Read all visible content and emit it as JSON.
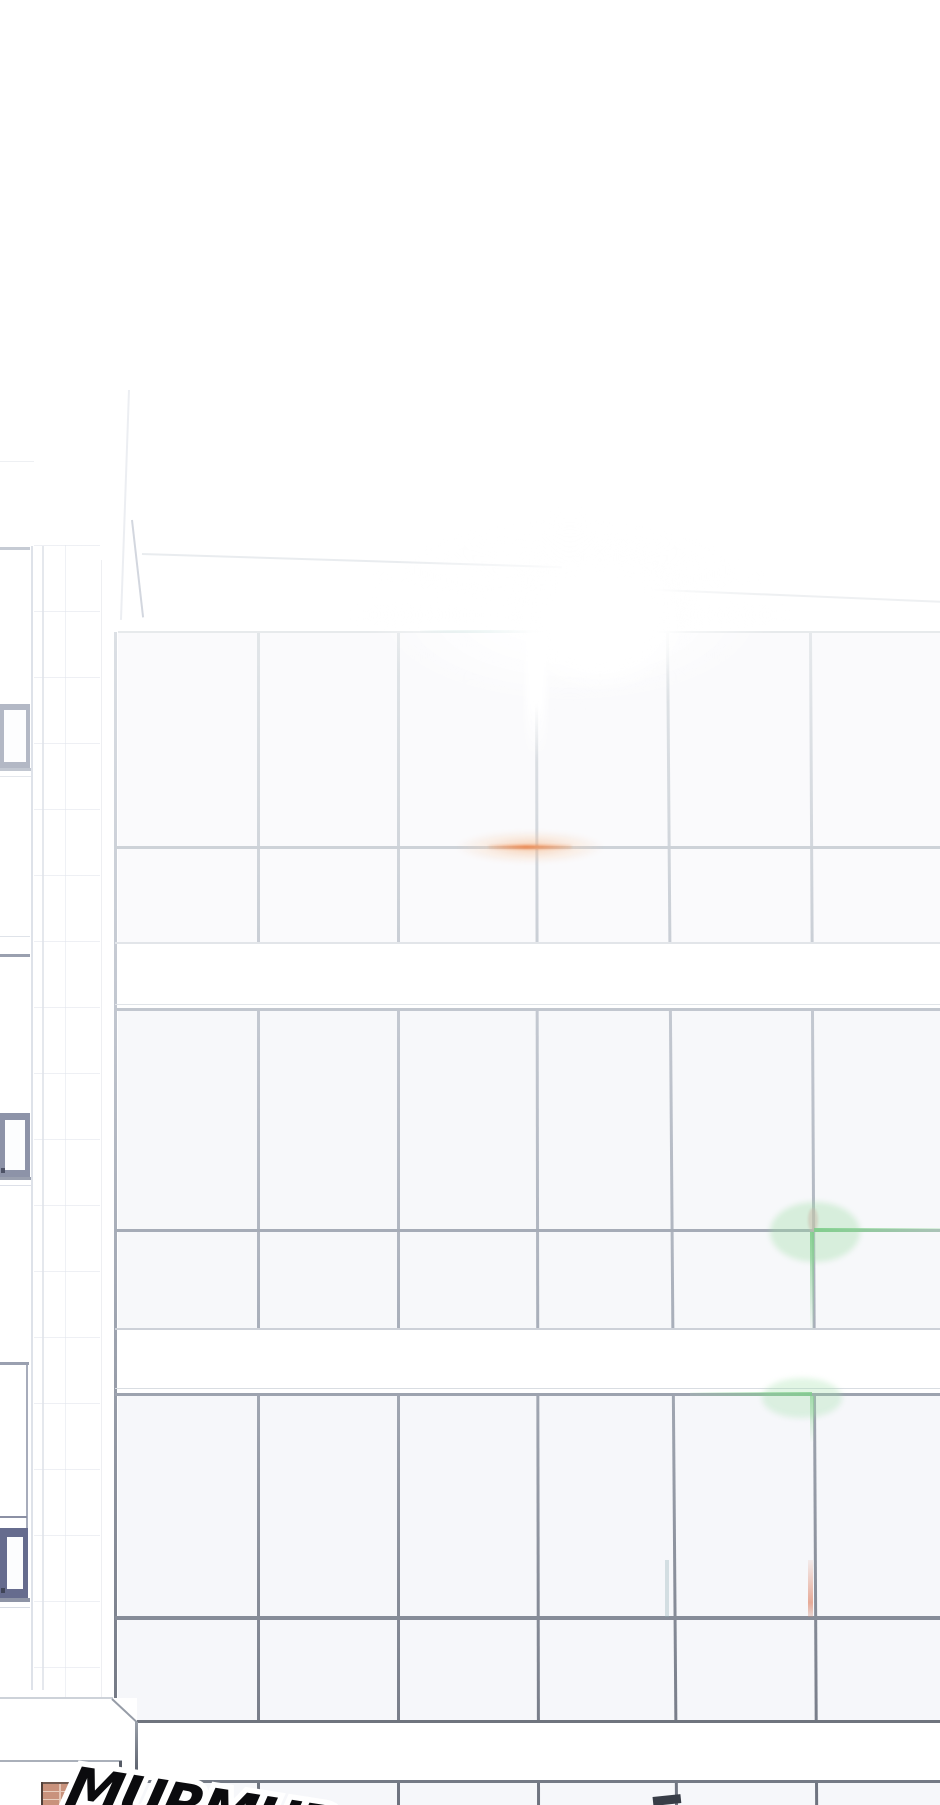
{
  "panel": {
    "type": "webtoon-panel",
    "scene": "low-angle view of a sunlit office building glass curtain wall, white overexposed sky, tiled side building on the left, street level with brick pillar at bottom"
  },
  "sfx": {
    "text": "MURMUR",
    "style": "bold italic black with white outline, partially cut off at bottom edge"
  },
  "palette": {
    "background": "#ffffff",
    "mullion_top": "#e2e6e9",
    "mullion_bottom": "#6e737f",
    "flare_orange": "#ee8246",
    "flare_green": "#80ce8c",
    "flare_cyan": "#8cc4be",
    "flare_salmon": "#e08a6e",
    "brick": "#c9927c",
    "sash_frame_dark": "#7a8099"
  },
  "layers": [
    {
      "name": "glass-tints",
      "items": [
        {
          "n": "glass-floor1-tint",
          "l": 118,
          "t": 633,
          "w": 822,
          "h": 309,
          "bg": "rgba(243,245,248,0.45)"
        },
        {
          "n": "glass-floor2-tint",
          "l": 118,
          "t": 1011,
          "w": 822,
          "h": 317,
          "bg": "rgba(240,242,246,0.5)"
        },
        {
          "n": "glass-floor3-tint",
          "l": 118,
          "t": 1396,
          "w": 822,
          "h": 324,
          "bg": "rgba(238,240,245,0.55)"
        },
        {
          "n": "glass-bottom-tint",
          "l": 137,
          "t": 1783,
          "w": 803,
          "h": 22,
          "bg": "rgba(238,240,245,0.5)"
        }
      ]
    },
    {
      "name": "side-building",
      "items": [
        {
          "n": "tile-wall-texture",
          "l": 34,
          "t": 545,
          "w": 66,
          "h": 1213,
          "bg": "repeating-linear-gradient(180deg, rgba(226,229,236,0.6) 0px 1px, rgba(0,0,0,0) 1px 66px)"
        },
        {
          "n": "tile-joint-vertical",
          "l": 65,
          "t": 545,
          "w": 1,
          "h": 1213,
          "bg": "rgba(226,229,236,0.55)"
        },
        {
          "n": "bay-corner-line-inner",
          "l": 31,
          "t": 546,
          "w": 2,
          "h": 1144,
          "bg": "rgba(214,219,227,0.8)"
        },
        {
          "n": "bay-corner-line-outer",
          "l": 42,
          "t": 546,
          "w": 2,
          "h": 1144,
          "bg": "rgba(222,226,233,0.8)"
        },
        {
          "n": "facade-column-edge-line",
          "l": 101,
          "t": 560,
          "w": 1,
          "h": 1138,
          "bg": "rgba(226,229,234,0.6)"
        },
        {
          "n": "tower-edge-upper",
          "l": 128,
          "t": 390,
          "w": 2,
          "h": 230,
          "bg": "rgba(228,231,237,0.7)",
          "r": 2,
          "o": "50% 0"
        },
        {
          "n": "tower-edge-lower",
          "l": 131,
          "t": 520,
          "w": 2,
          "h": 98,
          "bg": "rgba(203,208,217,0.85)",
          "r": -6.5,
          "o": "50% 0"
        },
        {
          "n": "roofline-near",
          "l": 142,
          "t": 553,
          "w": 420,
          "h": 2,
          "bg": "rgba(231,234,237,0.9)",
          "r": 1.8,
          "o": "left center"
        },
        {
          "n": "roofline-far",
          "l": 540,
          "t": 584,
          "w": 402,
          "h": 2,
          "bg": "rgba(236,238,241,0.9)",
          "r": 2.4,
          "o": "left center"
        },
        {
          "n": "parapet-faint-line",
          "l": 0,
          "t": 461,
          "w": 34,
          "h": 1,
          "bg": "rgba(236,238,242,0.9)"
        },
        {
          "n": "window-bay1-lintel",
          "l": 0,
          "t": 547,
          "w": 30,
          "h": 3,
          "bg": "#c6cbd4"
        },
        {
          "n": "window-bay1-sash-frame",
          "l": 0,
          "t": 704,
          "w": 30,
          "h": 64,
          "bg": "#b3b8c5"
        },
        {
          "n": "window-bay1-sash-pane",
          "l": 4,
          "t": 710,
          "w": 22,
          "h": 52,
          "bg": "#fdfdfe"
        },
        {
          "n": "window-bay1-sill",
          "l": 0,
          "t": 768,
          "w": 31,
          "h": 3,
          "bg": "#c2c7d1"
        },
        {
          "n": "window-bay1-sill-shadow",
          "l": 0,
          "t": 776,
          "w": 31,
          "h": 1,
          "bg": "#e4e7ec"
        },
        {
          "n": "window-bay2-lintel-hi",
          "l": 0,
          "t": 936,
          "w": 30,
          "h": 1,
          "bg": "#dfe3e9"
        },
        {
          "n": "window-bay2-lintel",
          "l": 0,
          "t": 954,
          "w": 30,
          "h": 3,
          "bg": "#9aa0af"
        },
        {
          "n": "window-bay2-sash-frame",
          "l": 0,
          "t": 1113,
          "w": 30,
          "h": 64,
          "bg": "#8d93a8"
        },
        {
          "n": "window-bay2-sash-pane",
          "l": 5,
          "t": 1120,
          "w": 20,
          "h": 50,
          "bg": "#fcfdfe"
        },
        {
          "n": "window-bay2-latch",
          "l": 1,
          "t": 1168,
          "w": 4,
          "h": 5,
          "bg": "#4d5266"
        },
        {
          "n": "window-bay2-sill",
          "l": 0,
          "t": 1177,
          "w": 31,
          "h": 3,
          "bg": "#9aa0af"
        },
        {
          "n": "window-bay2-sill-shadow",
          "l": 0,
          "t": 1185,
          "w": 31,
          "h": 1,
          "bg": "#dde0e8"
        },
        {
          "n": "window-bay3-lintel",
          "l": 0,
          "t": 1362,
          "w": 29,
          "h": 3,
          "bg": "#9aa0b0"
        },
        {
          "n": "window-bay3-side-line",
          "l": 26,
          "t": 1365,
          "w": 2,
          "h": 165,
          "bg": "#a7acbb"
        },
        {
          "n": "window-bay3-divider",
          "l": 0,
          "t": 1516,
          "w": 27,
          "h": 2,
          "bg": "#8b90a4"
        },
        {
          "n": "window-bay3-sash-frame",
          "l": 0,
          "t": 1528,
          "w": 28,
          "h": 70,
          "bg": "#666c8e"
        },
        {
          "n": "window-bay3-sash-pane",
          "l": 7,
          "t": 1537,
          "w": 16,
          "h": 52,
          "bg": "#fcfdfe"
        },
        {
          "n": "window-bay3-latch",
          "l": 1,
          "t": 1588,
          "w": 4,
          "h": 5,
          "bg": "#3f4457"
        },
        {
          "n": "window-bay3-sill",
          "l": 0,
          "t": 1598,
          "w": 30,
          "h": 4,
          "bg": "#8e94a6"
        },
        {
          "n": "window-bay3-sill-shadow",
          "l": 0,
          "t": 1607,
          "w": 30,
          "h": 1,
          "bg": "#d8dce4"
        }
      ]
    },
    {
      "name": "mullions",
      "items": [
        {
          "n": "mullion-col2",
          "l": 257,
          "t": 632,
          "w": 3,
          "h": 1173,
          "bg": "linear-gradient(180deg,#e2e6e9,#c6cbd3 30%,#a8aeb9 60%,#6e737f)"
        },
        {
          "n": "mullion-col3",
          "l": 397,
          "t": 632,
          "w": 3,
          "h": 1173,
          "bg": "linear-gradient(180deg,#e2e6e9,#c6cbd3 30%,#a8aeb9 60%,#6e737f)"
        },
        {
          "n": "mullion-col4",
          "l": 535,
          "t": 632,
          "w": 3,
          "h": 1173,
          "bg": "linear-gradient(180deg,#e6e9ec,#c6cbd3 30%,#a8aeb9 60%,#6e737f)",
          "r": -0.1,
          "o": "50% 0"
        },
        {
          "n": "mullion-col5",
          "l": 666,
          "t": 632,
          "w": 3,
          "h": 1173,
          "bg": "linear-gradient(180deg,#e2e6e9,#c6cbd3 30%,#a8aeb9 60%,#6e737f)",
          "r": -0.44,
          "o": "50% 0"
        },
        {
          "n": "mullion-col6",
          "l": 809,
          "t": 632,
          "w": 3,
          "h": 1173,
          "bg": "linear-gradient(180deg,#e6e9ec,#c6cbd3 30%,#a8aeb9 60%,#6e737f)",
          "r": -0.3,
          "o": "50% 0"
        }
      ]
    },
    {
      "name": "bands",
      "items": [
        {
          "n": "spandrel-band-1",
          "l": 118,
          "t": 942,
          "w": 822,
          "h": 66,
          "bg": "#ffffff"
        },
        {
          "n": "spandrel-band-2",
          "l": 118,
          "t": 1328,
          "w": 822,
          "h": 65,
          "bg": "#ffffff"
        },
        {
          "n": "spandrel-band-3",
          "l": 137,
          "t": 1723,
          "w": 803,
          "h": 57,
          "bg": "#ffffff"
        }
      ]
    },
    {
      "name": "hlines",
      "items": [
        {
          "n": "facade-edge-line",
          "l": 114,
          "t": 632,
          "w": 3,
          "h": 1068,
          "bg": "linear-gradient(180deg,#dce0e5,#c2c7d0 35%,#9ea4b0 65%,#757a86)"
        },
        {
          "n": "grid-top-line",
          "l": 118,
          "t": 631,
          "w": 822,
          "h": 2,
          "bg": "#e7eaec"
        },
        {
          "n": "floor1-mid-mullion",
          "l": 115,
          "t": 846,
          "w": 825,
          "h": 3,
          "bg": "#cdd2d8"
        },
        {
          "n": "floor1-sill-line",
          "l": 115,
          "t": 942,
          "w": 825,
          "h": 2,
          "bg": "#e2e5e9"
        },
        {
          "n": "floor2-lintel-faint",
          "l": 115,
          "t": 1004,
          "w": 825,
          "h": 1,
          "bg": "#e0e4e8"
        },
        {
          "n": "floor2-top-line",
          "l": 115,
          "t": 1008,
          "w": 825,
          "h": 3,
          "bg": "#c2c7cf"
        },
        {
          "n": "floor2-mid-mullion",
          "l": 115,
          "t": 1229,
          "w": 825,
          "h": 3,
          "bg": "#a6acb7"
        },
        {
          "n": "floor2-sill-line",
          "l": 115,
          "t": 1328,
          "w": 825,
          "h": 2,
          "bg": "#cdd1d8"
        },
        {
          "n": "floor3-lintel-faint",
          "l": 115,
          "t": 1388,
          "w": 825,
          "h": 1,
          "bg": "#d9dde2"
        },
        {
          "n": "floor3-top-line",
          "l": 115,
          "t": 1393,
          "w": 825,
          "h": 3,
          "bg": "#9da3af"
        },
        {
          "n": "floor3-mid-mullion",
          "l": 115,
          "t": 1616,
          "w": 825,
          "h": 4,
          "bg": "#868c98"
        },
        {
          "n": "facade-bottom-line",
          "l": 137,
          "t": 1720,
          "w": 803,
          "h": 3,
          "bg": "#6f747e"
        },
        {
          "n": "street-level-line",
          "l": 137,
          "t": 1780,
          "w": 803,
          "h": 3,
          "bg": "#747a85"
        }
      ]
    },
    {
      "name": "flares",
      "items": [
        {
          "n": "lens-flare-cyan-streak",
          "l": 420,
          "t": 630,
          "w": 128,
          "h": 3,
          "bg": "linear-gradient(90deg, rgba(150,200,195,0.05), rgba(140,196,190,0.6) 55%, rgba(170,214,208,0.15))"
        },
        {
          "n": "lens-flare-orange-glow",
          "l": 455,
          "t": 830,
          "w": 150,
          "h": 34,
          "bg": "radial-gradient(closest-side, rgba(245,170,115,0.55), rgba(248,200,160,0.28) 55%, rgba(255,255,255,0))",
          "rad": "50%",
          "blur": 2
        },
        {
          "n": "lens-flare-orange-streak",
          "l": 488,
          "t": 845,
          "w": 84,
          "h": 4,
          "bg": "linear-gradient(90deg, rgba(242,150,90,0.15), rgba(238,130,70,0.8) 45%, rgba(242,160,105,0.2))",
          "rad": "2px",
          "blur": 1
        },
        {
          "n": "lens-flare-pink-dot",
          "l": 808,
          "t": 1208,
          "w": 10,
          "h": 24,
          "bg": "rgba(232,168,178,0.5)",
          "rad": "50%",
          "blur": 1
        },
        {
          "n": "lens-flare-green1-glow",
          "l": 770,
          "t": 1202,
          "w": 90,
          "h": 60,
          "bg": "rgba(156,222,164,0.35)",
          "rad": "50%",
          "blur": 3
        },
        {
          "n": "lens-flare-green1-h",
          "l": 814,
          "t": 1228,
          "w": 126,
          "h": 4,
          "bg": "linear-gradient(90deg, rgba(128,206,140,0.95), rgba(178,228,184,0.4))"
        },
        {
          "n": "lens-flare-green1-v",
          "l": 810,
          "t": 1232,
          "w": 4,
          "h": 98,
          "bg": "linear-gradient(180deg, rgba(128,206,140,0.9), rgba(200,236,205,0.08))"
        },
        {
          "n": "lens-flare-green2-glow",
          "l": 762,
          "t": 1378,
          "w": 80,
          "h": 40,
          "bg": "rgba(156,222,164,0.3)",
          "rad": "50%",
          "blur": 3
        },
        {
          "n": "lens-flare-green2-h",
          "l": 690,
          "t": 1392,
          "w": 122,
          "h": 4,
          "bg": "linear-gradient(90deg, rgba(190,232,195,0.12), rgba(128,206,140,0.8))"
        },
        {
          "n": "lens-flare-green2-v",
          "l": 810,
          "t": 1396,
          "w": 4,
          "h": 46,
          "bg": "linear-gradient(180deg, rgba(140,212,150,0.7), rgba(210,240,214,0.05))"
        },
        {
          "n": "lens-flare-salmon-tint",
          "l": 808,
          "t": 1560,
          "w": 5,
          "h": 57,
          "bg": "linear-gradient(180deg, rgba(222,148,126,0.12), rgba(224,138,110,0.7) 75%, rgba(200,140,125,0.3))"
        },
        {
          "n": "lens-flare-teal-tint",
          "l": 665,
          "t": 1560,
          "w": 4,
          "h": 57,
          "bg": "rgba(146,176,180,0.35)"
        }
      ]
    },
    {
      "name": "bloom",
      "items": [
        {
          "n": "sun-bloom-wide",
          "l": 360,
          "t": 520,
          "w": 420,
          "h": 190,
          "bg": "radial-gradient(closest-side, rgba(255,255,255,0.85) 40%, rgba(255,255,255,0))",
          "rad": "50%",
          "blur": 8
        },
        {
          "n": "sun-bloom-core",
          "l": 505,
          "t": 540,
          "w": 190,
          "h": 155,
          "bg": "radial-gradient(closest-side, #ffffff 60%, rgba(255,255,255,0))",
          "rad": "50%",
          "blur": 6
        },
        {
          "n": "mullion-fade-wash",
          "l": 526,
          "t": 632,
          "w": 20,
          "h": 130,
          "bg": "linear-gradient(180deg, #ffffff 55%, rgba(255,255,255,0))",
          "blur": 4
        }
      ]
    },
    {
      "name": "street",
      "items": [
        {
          "n": "ledge-mask",
          "l": 0,
          "t": 1698,
          "w": 137,
          "h": 84,
          "bg": "#ffffff"
        },
        {
          "n": "ledge-top-line",
          "l": 0,
          "t": 1697,
          "w": 113,
          "h": 2,
          "bg": "rgba(200,205,213,0.9)"
        },
        {
          "n": "ledge-corner-diagonal",
          "l": 112,
          "t": 1698,
          "w": 34,
          "h": 2,
          "bg": "#969ca7",
          "r": 43,
          "o": "left center"
        },
        {
          "n": "ledge-corner-vertical",
          "l": 135,
          "t": 1722,
          "w": 3,
          "h": 60,
          "bg": "linear-gradient(180deg,#9aa0aa,#4f5460)"
        },
        {
          "n": "ledge-mid-line",
          "l": 0,
          "t": 1760,
          "w": 122,
          "h": 2,
          "bg": "#aab0ba"
        },
        {
          "n": "ledge-front-vertical",
          "l": 119,
          "t": 1761,
          "w": 3,
          "h": 22,
          "bg": "#565b66"
        },
        {
          "n": "ledge-front-diagonal",
          "l": 120,
          "t": 1779,
          "w": 22,
          "h": 3,
          "bg": "#3c414b",
          "r": 33,
          "o": "left center"
        },
        {
          "n": "facade-edge-bottom-stub",
          "l": 113,
          "t": 1781,
          "w": 4,
          "h": 24,
          "bg": "#626773"
        },
        {
          "n": "brick-pillar",
          "l": 42,
          "t": 1783,
          "w": 36,
          "h": 22,
          "bg": "repeating-linear-gradient(180deg, rgba(232,203,187,0.95) 0px 1px, #c9927c 1px 8px)"
        },
        {
          "n": "brick-pillar-joint",
          "l": 59,
          "t": 1783,
          "w": 2,
          "h": 22,
          "bg": "rgba(232,203,187,0.9)"
        },
        {
          "n": "brick-pillar-top-line",
          "l": 42,
          "t": 1782,
          "w": 36,
          "h": 2,
          "bg": "#6f584e"
        },
        {
          "n": "brick-pillar-left-line",
          "l": 41,
          "t": 1782,
          "w": 2,
          "h": 23,
          "bg": "#514039"
        },
        {
          "n": "street-dark-wedge",
          "l": 653,
          "t": 1797,
          "w": 28,
          "h": 9,
          "bg": "#383d47",
          "r": -6,
          "o": "left center"
        }
      ]
    }
  ]
}
